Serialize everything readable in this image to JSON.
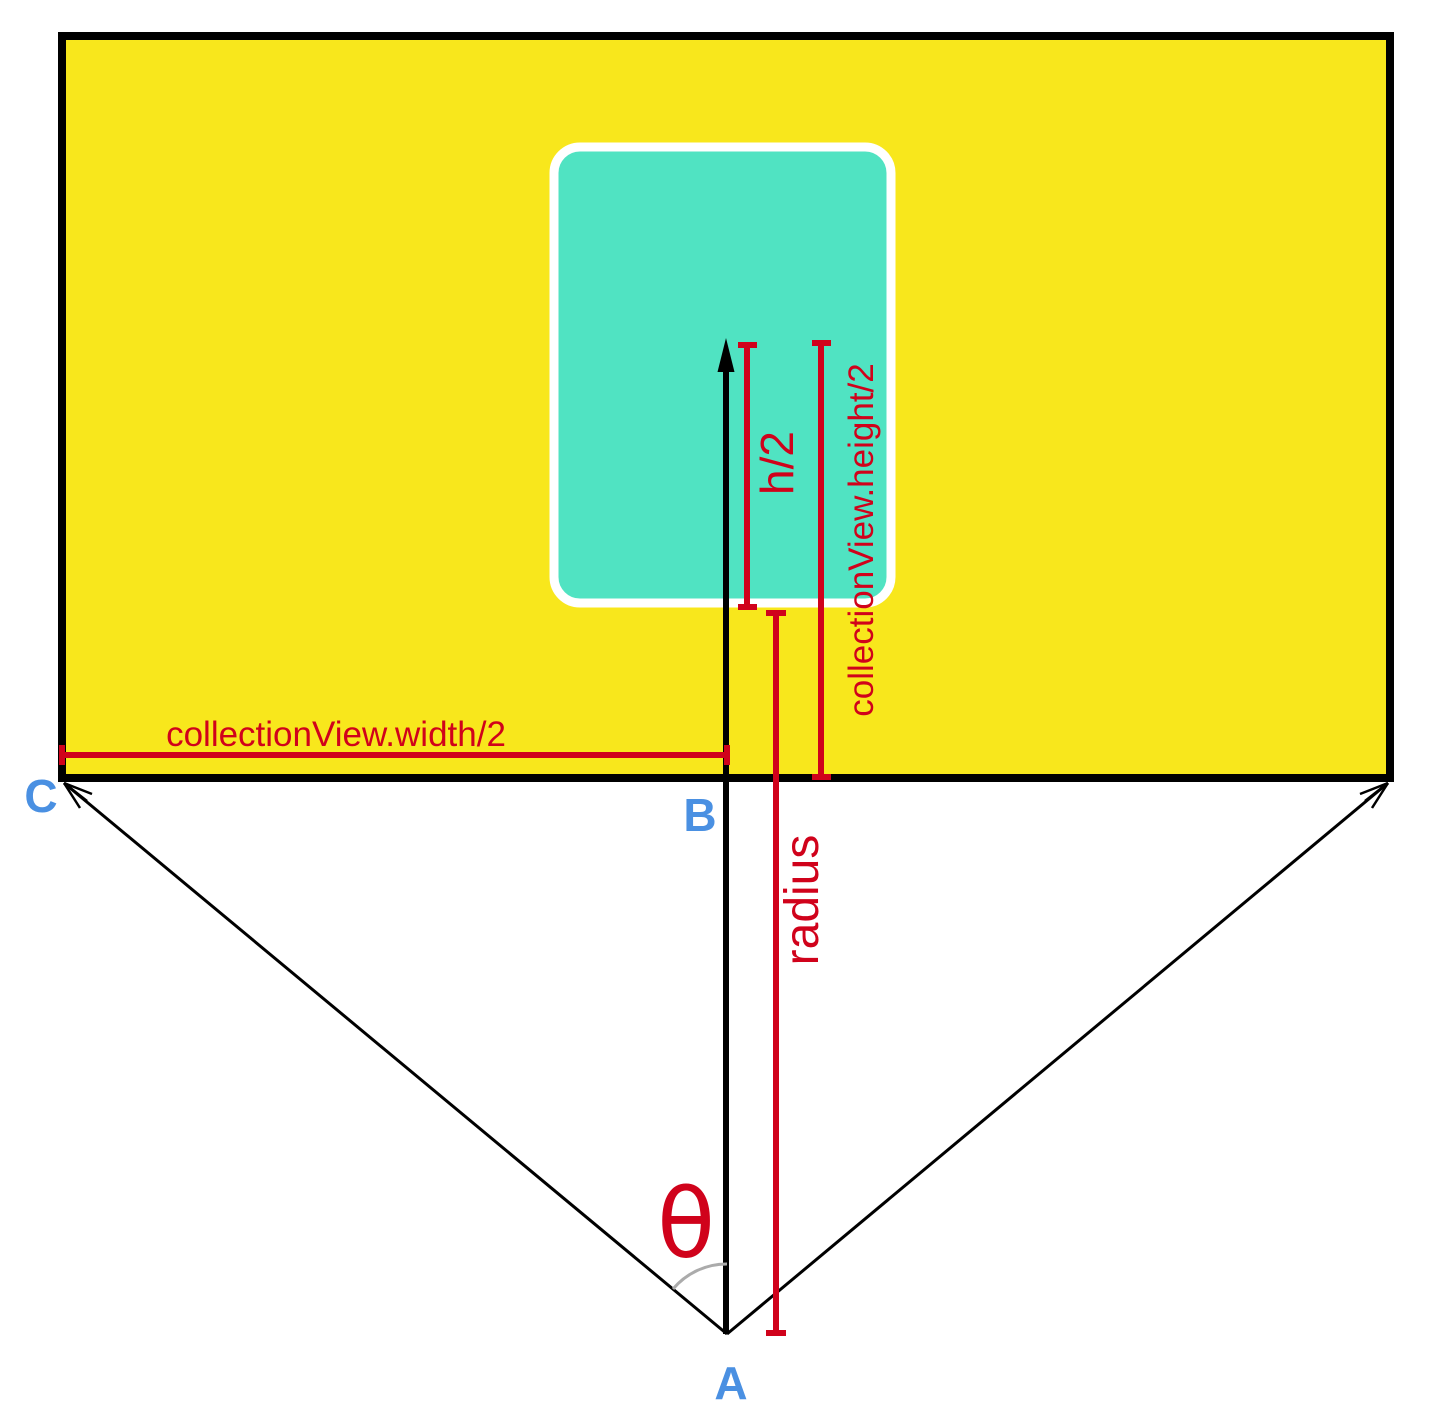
{
  "colors": {
    "background": "#FFFFFF",
    "collection_view_fill": "#F8E71C",
    "collection_view_border": "#000000",
    "cell_fill": "#50E3C2",
    "cell_border": "#FFFFFF",
    "measure": "#D0021B",
    "vector": "#000000",
    "angle_arc": "#ABABAB",
    "point_label": "#4A90E2"
  },
  "labels": {
    "width_half": "collectionView.width/2",
    "cell_height_half": "h/2",
    "view_height_half": "collectionView.height/2",
    "radius": "radius",
    "theta": "θ",
    "point_a": "A",
    "point_b": "B",
    "point_c": "C"
  }
}
